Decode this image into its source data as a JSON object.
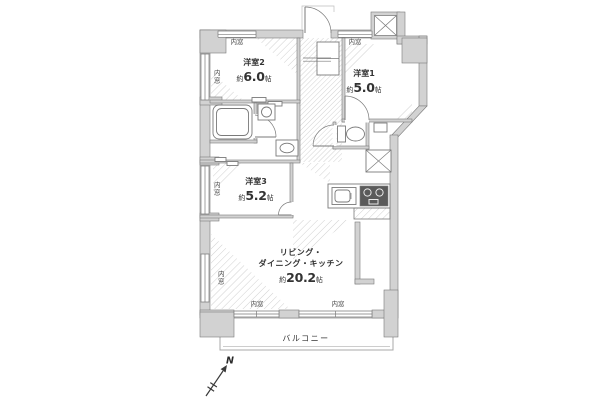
{
  "plan": {
    "north_label": "N",
    "window_label": "内窓",
    "balcony_label": "バルコニー",
    "rooms": {
      "room2": {
        "name": "洋室2",
        "size_prefix": "約",
        "size_value": "6.0",
        "size_unit": "帖"
      },
      "room1": {
        "name": "洋室1",
        "size_prefix": "約",
        "size_value": "5.0",
        "size_unit": "帖"
      },
      "room3": {
        "name": "洋室3",
        "size_prefix": "約",
        "size_value": "5.2",
        "size_unit": "帖"
      },
      "ldk": {
        "name_line1": "リビング・",
        "name_line2": "ダイニング・キッチン",
        "size_prefix": "約",
        "size_value": "20.2",
        "size_unit": "帖"
      }
    },
    "colors": {
      "wall_fill": "#d2d2d2",
      "wall_stroke": "#7a7a7a",
      "line": "#7a7a7a",
      "hatch": "#d0d0d0",
      "stove": "#5a5a5a",
      "text": "#333333",
      "bg": "#ffffff"
    }
  }
}
